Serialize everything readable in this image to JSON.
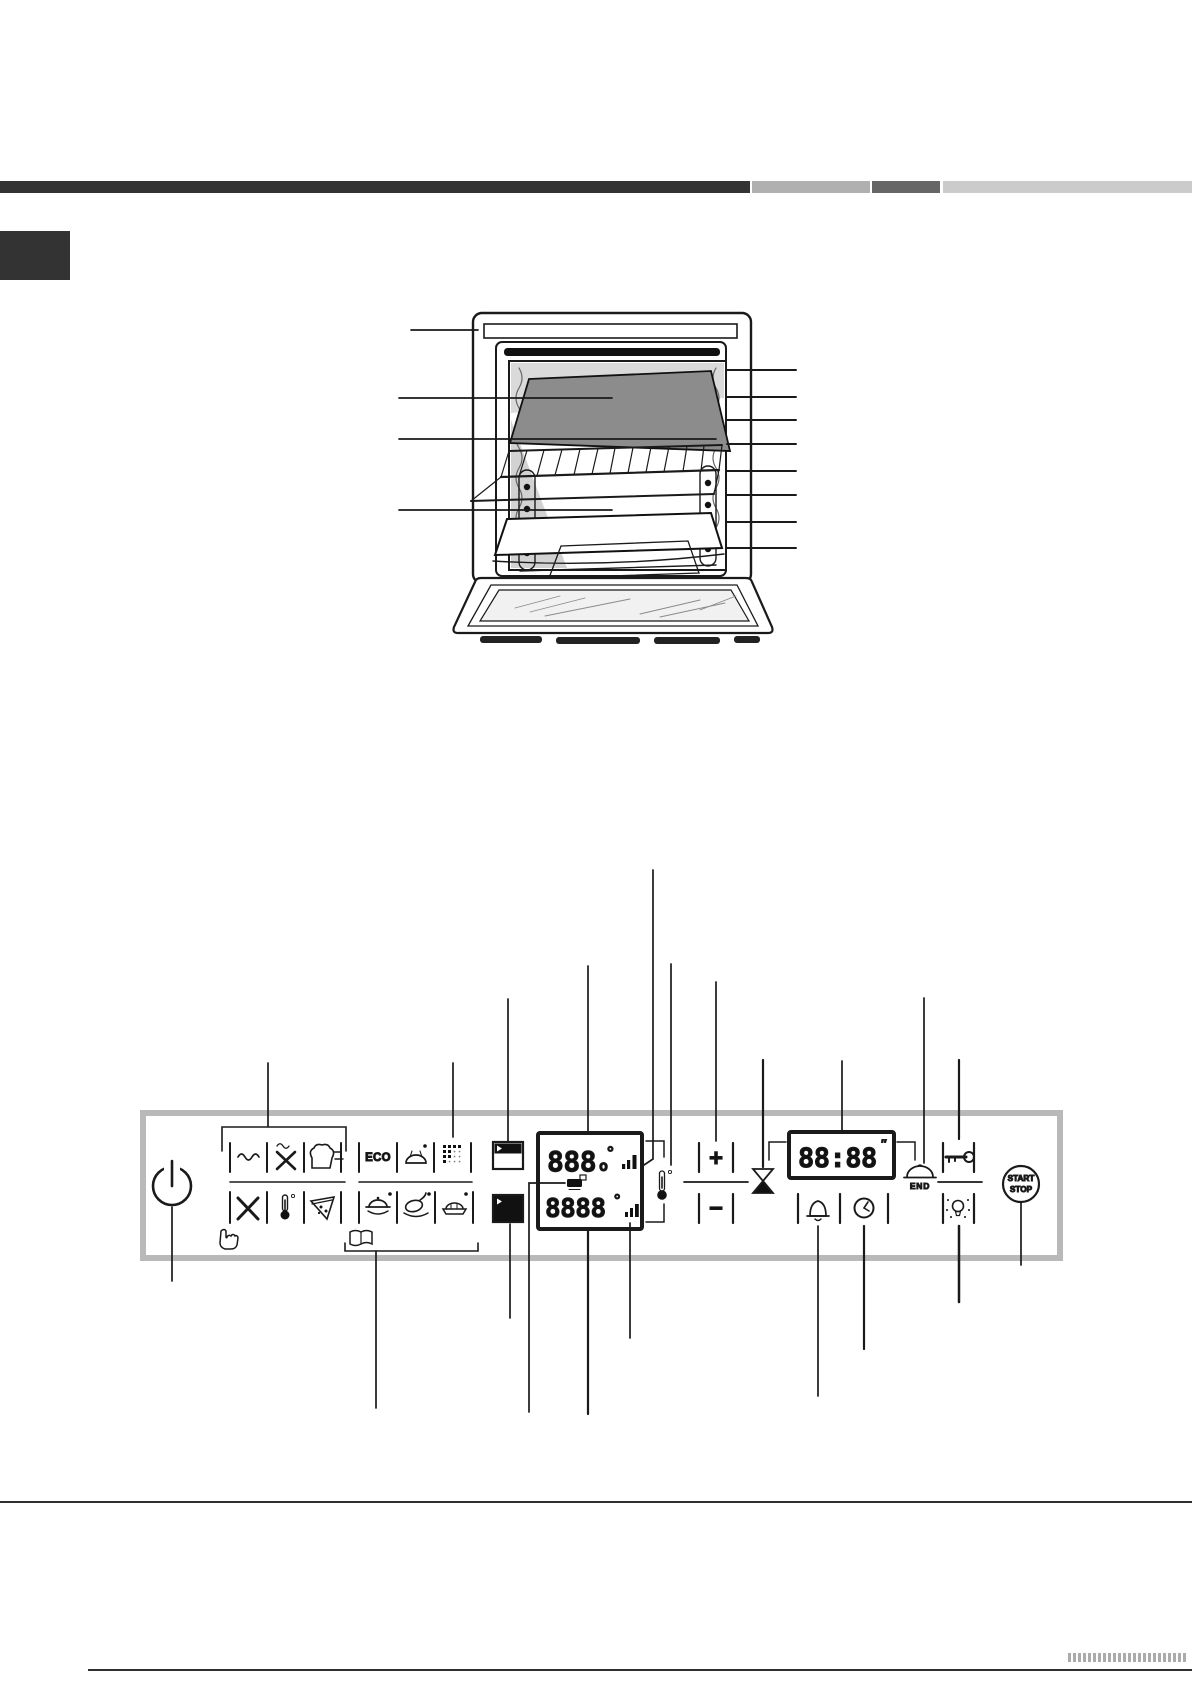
{
  "page": {
    "background": "#ffffff"
  },
  "header": {
    "rule_segments": [
      {
        "name": "dark",
        "color": "#333333"
      },
      {
        "name": "gray",
        "color": "#b0b0b0"
      },
      {
        "name": "mid",
        "color": "#666666"
      },
      {
        "name": "light",
        "color": "#cbcbcb"
      }
    ],
    "section_marker_color": "#333333"
  },
  "oven_figure": {
    "left_callout_count": 4,
    "right_callout_count": 8,
    "tray_color": "#8c8c8c"
  },
  "control_panel": {
    "frame_color": "#b9b9b9",
    "eco_label": "ECO",
    "main_display": {
      "row1_digits": "888",
      "row1_small": "o",
      "row1_degree": "°",
      "row2_digits": "8888",
      "row2_degree": "°"
    },
    "timer_display": {
      "digits": "88:88",
      "seconds_mark": "″"
    },
    "end_label": "END",
    "plus_label": "+",
    "minus_label": "−",
    "start_label": "START",
    "stop_label": "STOP",
    "icons": [
      "power-icon",
      "wavy-heat-icon",
      "fast-cook-star-icon",
      "toast-icon",
      "bread-icon",
      "multilevel-icon",
      "fan-icon",
      "thermometer-icon",
      "pizza-icon",
      "casserole-icon",
      "poultry-icon",
      "gratin-icon",
      "touch-hand-icon",
      "recipe-book-icon",
      "display-contrast-light-icon",
      "display-contrast-dark-icon",
      "grill-tray-indicator-icon",
      "temperature-icon",
      "hourglass-duration-icon",
      "end-time-icon",
      "plus-icon",
      "minus-icon",
      "bell-icon",
      "clock-icon",
      "key-lock-icon",
      "lamp-icon",
      "start-stop-button"
    ]
  },
  "footer": {
    "rule_color": "#2f2f2f"
  }
}
